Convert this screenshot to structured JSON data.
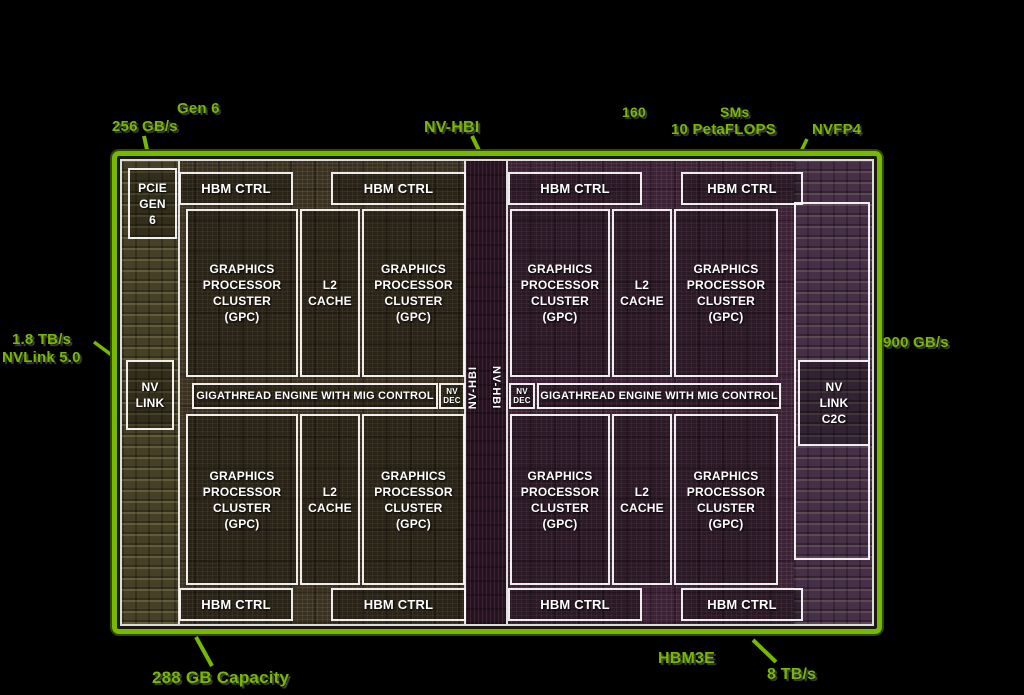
{
  "colors": {
    "nvidia_green": "#76b900"
  },
  "annotations": {
    "top_left": {
      "line1": "Gen 6",
      "line2": "256 GB/s"
    },
    "top_center": {
      "label": "NV-HBI"
    },
    "top_right": {
      "line1": "160 SMs",
      "line2": "10 PetaFLOPS",
      "side": "NVFP4"
    },
    "left": {
      "line1": "1.8 TB/s",
      "line2": "NVLink 5.0"
    },
    "right": {
      "label": "900 GB/s"
    },
    "bottom_left": {
      "label": "288 GB Capacity"
    },
    "bottom_right": {
      "line1": "HBM3E",
      "line2": "8 TB/s"
    }
  },
  "die": {
    "pcie": "PCIE\nGEN\n6",
    "hbm_ctrl": "HBM CTRL",
    "gpc": "GRAPHICS\nPROCESSOR\nCLUSTER\n(GPC)",
    "l2": "L2\nCACHE",
    "gigathread": "GIGATHREAD ENGINE WITH MIG CONTROL",
    "nvdec": "NV\nDEC",
    "nvlink": "NV\nLINK",
    "nvlink_c2c": "NV\nLINK\nC2C",
    "nv_hbi_vertical": "NV-HBI"
  }
}
